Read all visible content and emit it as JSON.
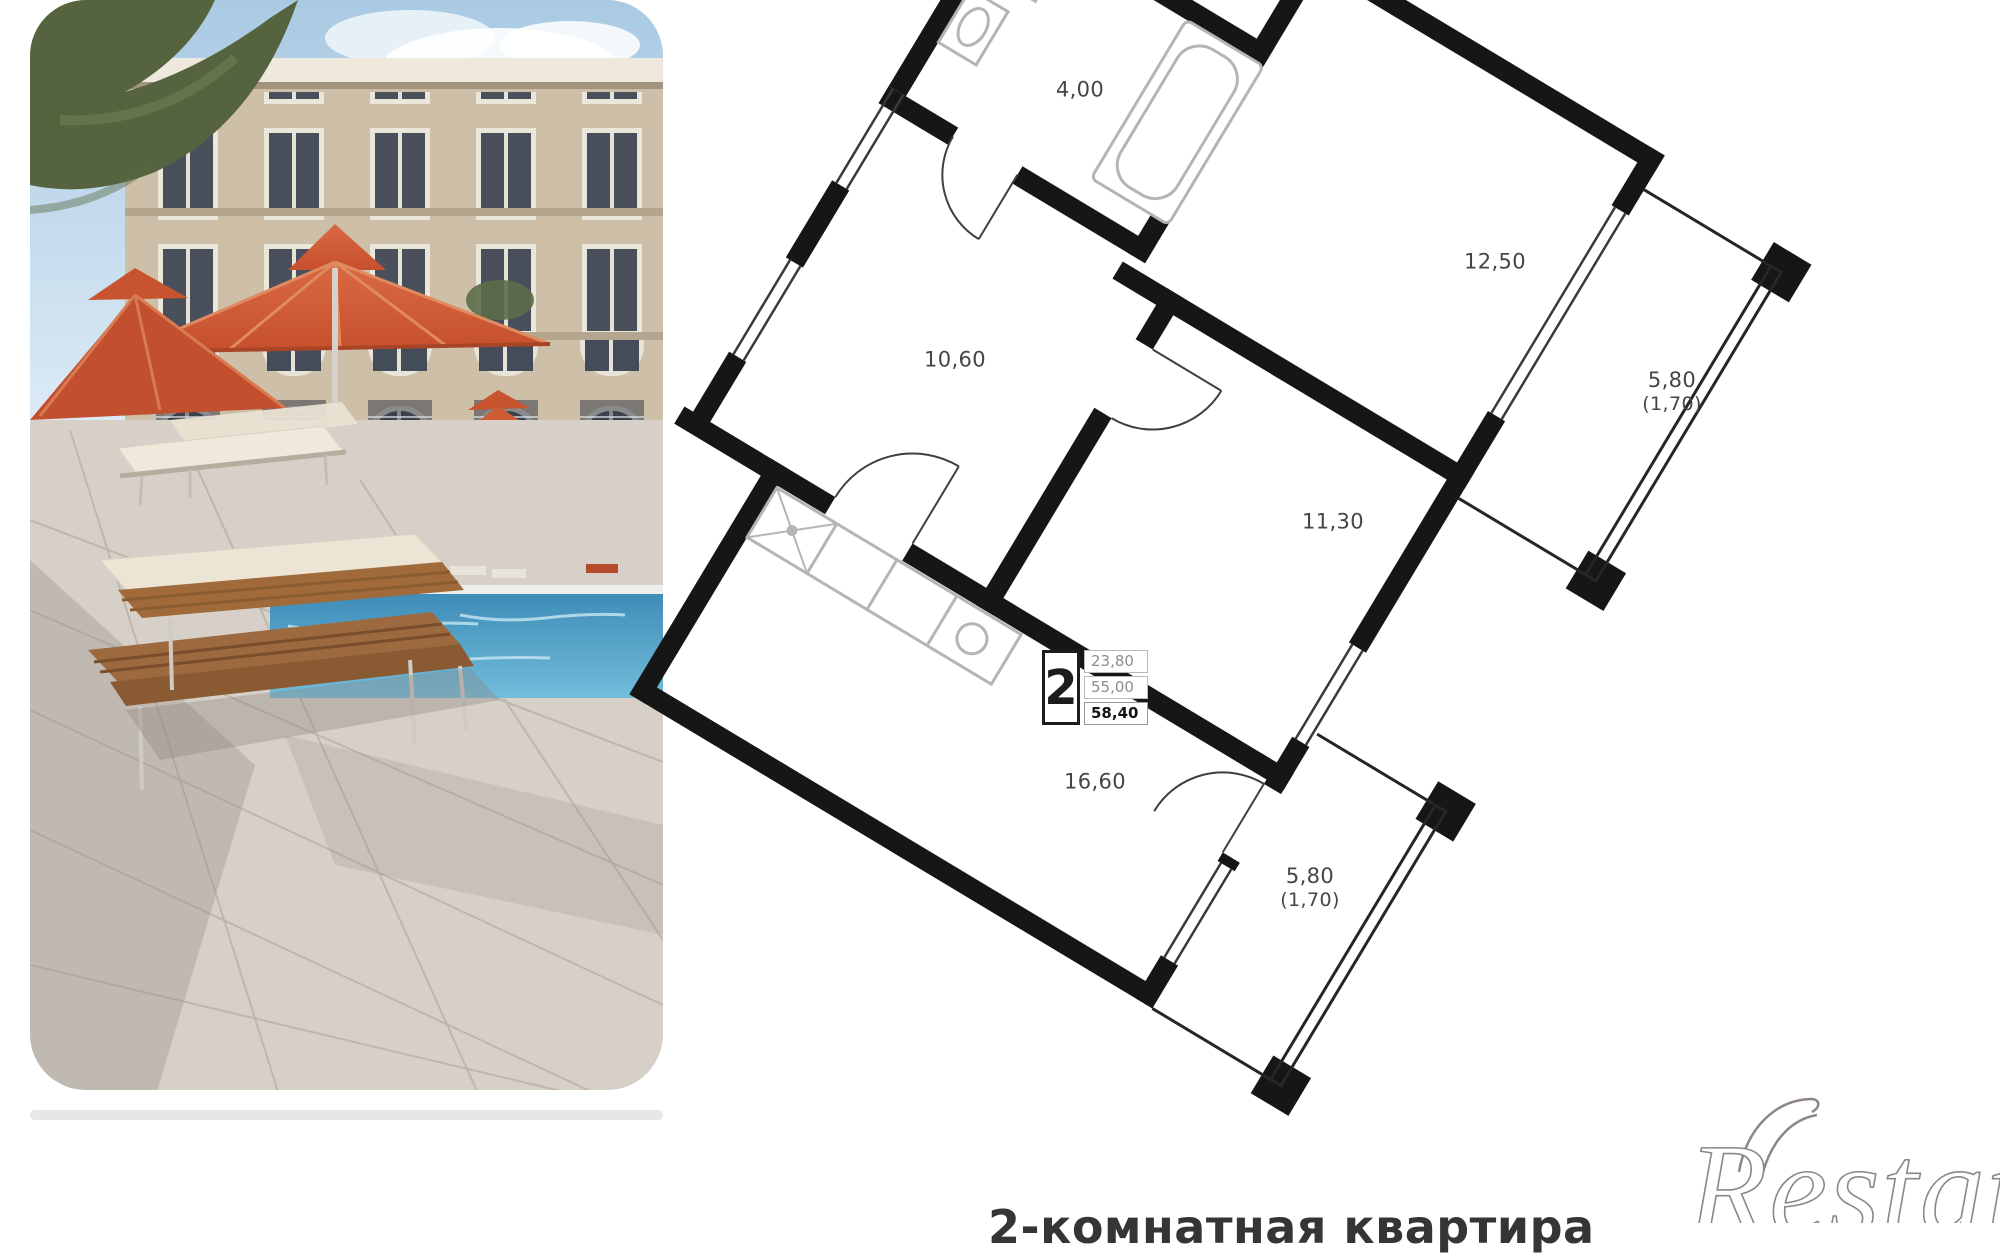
{
  "photo": {
    "subject": "courtyard pool with orange umbrellas and sun loungers"
  },
  "floor_plan": {
    "unit_badge": {
      "rooms": "2",
      "living_area": "23,80",
      "area_without_balconies": "55,00",
      "total_area": "58,40"
    },
    "room_labels": [
      {
        "id": "bathroom",
        "area": "4,00"
      },
      {
        "id": "bedroom",
        "area": "12,50"
      },
      {
        "id": "balcony-right",
        "area": "5,80",
        "reduced": "(1,70)"
      },
      {
        "id": "hallway",
        "area": "10,60"
      },
      {
        "id": "room",
        "area": "11,30"
      },
      {
        "id": "kitchen-living",
        "area": "16,60"
      },
      {
        "id": "balcony-bottom",
        "area": "5,80",
        "reduced": "(1,70)"
      }
    ]
  },
  "caption": {
    "title": "2-комнатная квартира"
  },
  "watermark": {
    "brand": "Restate"
  },
  "colors": {
    "wall": "#161616",
    "label_text": "#454545",
    "umbrella_accent": "#cf5a38",
    "pool": "#4a9cc2",
    "badge_total": "#141414",
    "badge_light": "#8d8d8d",
    "watermark_stroke": "#8d8683"
  }
}
